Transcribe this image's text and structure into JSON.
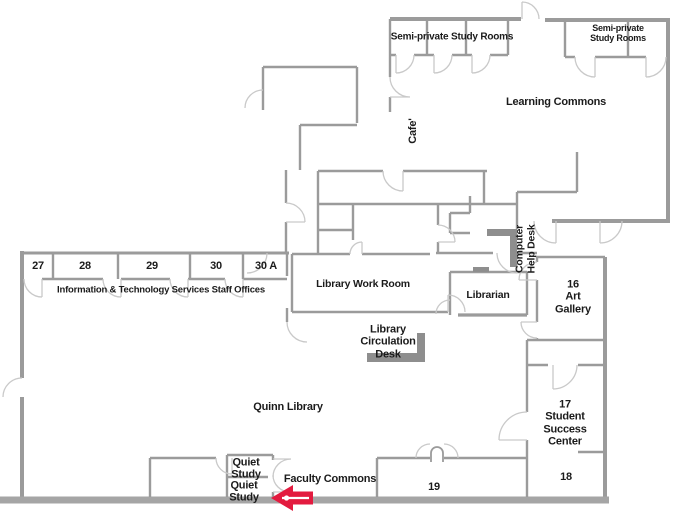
{
  "rooms": {
    "semi_private_left": "Semi-private Study Rooms",
    "semi_private_right": "Semi-private Study Rooms",
    "learning_commons": "Learning Commons",
    "cafe": "Cafe'",
    "computer_help_desk": "Computer\nHelp Desk",
    "library_work_room": "Library Work Room",
    "librarian": "Librarian",
    "art_gallery": "16\nArt\nGallery",
    "circulation_desk": "Library\nCirculation\nDesk",
    "quinn_library": "Quinn Library",
    "student_success_center": "17\nStudent\nSuccess\nCenter",
    "room_18": "18",
    "room_19": "19",
    "faculty_commons": "Faculty Commons",
    "quiet_study_upper": "Quiet\nStudy",
    "quiet_study_lower": "Quiet\nStudy",
    "office_27": "27",
    "office_28": "28",
    "office_29": "29",
    "office_30": "30",
    "office_30a": "30 A",
    "it_offices": "Information & Technology Services Staff Offices"
  },
  "colors": {
    "wall": "#9b9b9b",
    "bottom_wall": "#a5a5a5",
    "door_arc": "#c9c9c9",
    "desk": "#8e8e8e",
    "arrow": "#e31b3f",
    "text": "#1b1b1b",
    "background": "#ffffff"
  }
}
